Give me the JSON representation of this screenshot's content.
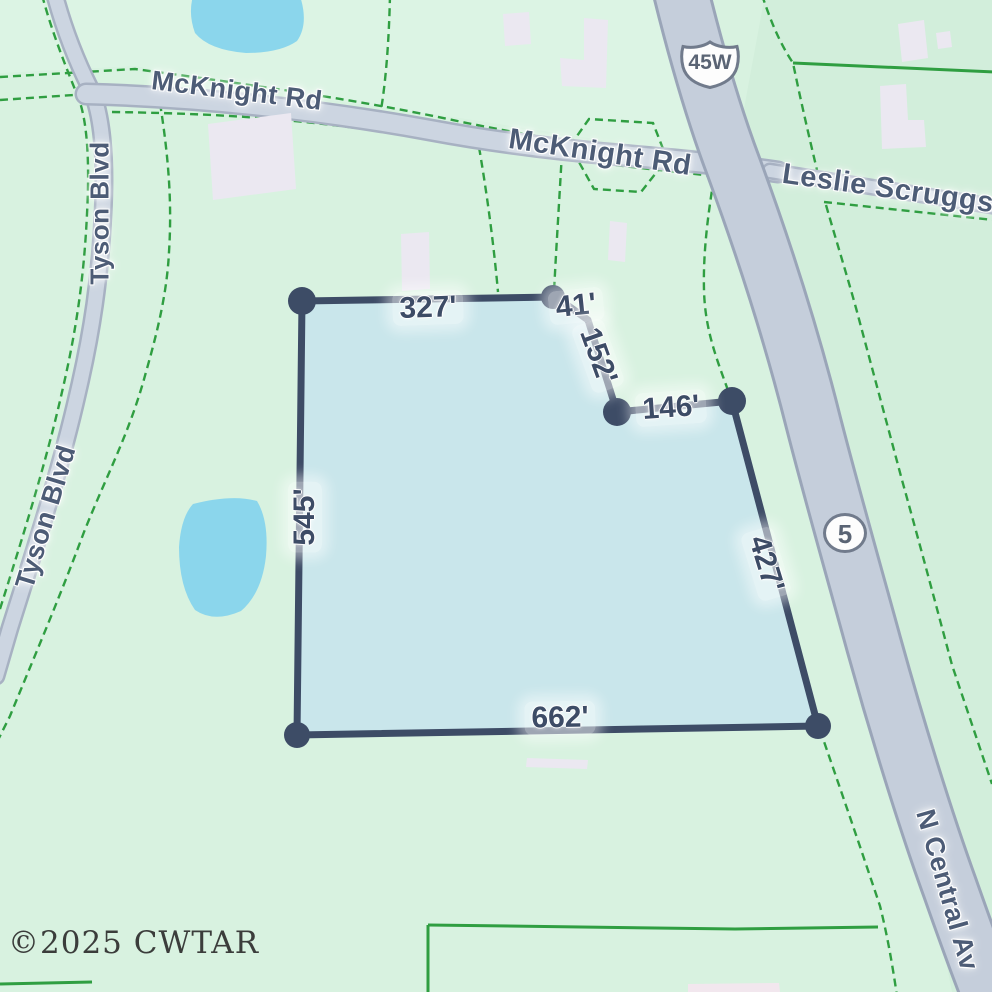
{
  "map": {
    "road_labels": {
      "mcknight_1": "McKnight Rd",
      "mcknight_2": "McKnight Rd",
      "tyson_1": "Tyson Blvd",
      "tyson_2": "Tyson Blvd",
      "leslie_scruggs": "Leslie Scruggs",
      "n_central": "N Central Av"
    },
    "route_shields": {
      "us_45w": "45W",
      "state_5": "5"
    },
    "parcel_dimensions": {
      "top": "327'",
      "top_jog": "41'",
      "upper_right_diagonal": "152'",
      "upper_right": "146'",
      "left": "545'",
      "right": "427'",
      "bottom": "662'"
    },
    "watermark": "©2025 CWTAR",
    "colors": {
      "land": "#d8f2e0",
      "land_north": "#dcf4e4",
      "land_east": "#d2eedb",
      "water": "#8bd6ec",
      "parcel_fill": "#c7e5ec",
      "parcel_outline": "#3d4c66",
      "road_fill": "#ccd5e1",
      "highway_fill": "#c5cedb",
      "boundary_line": "#2f9e41",
      "label_text": "#4d5c76"
    }
  }
}
